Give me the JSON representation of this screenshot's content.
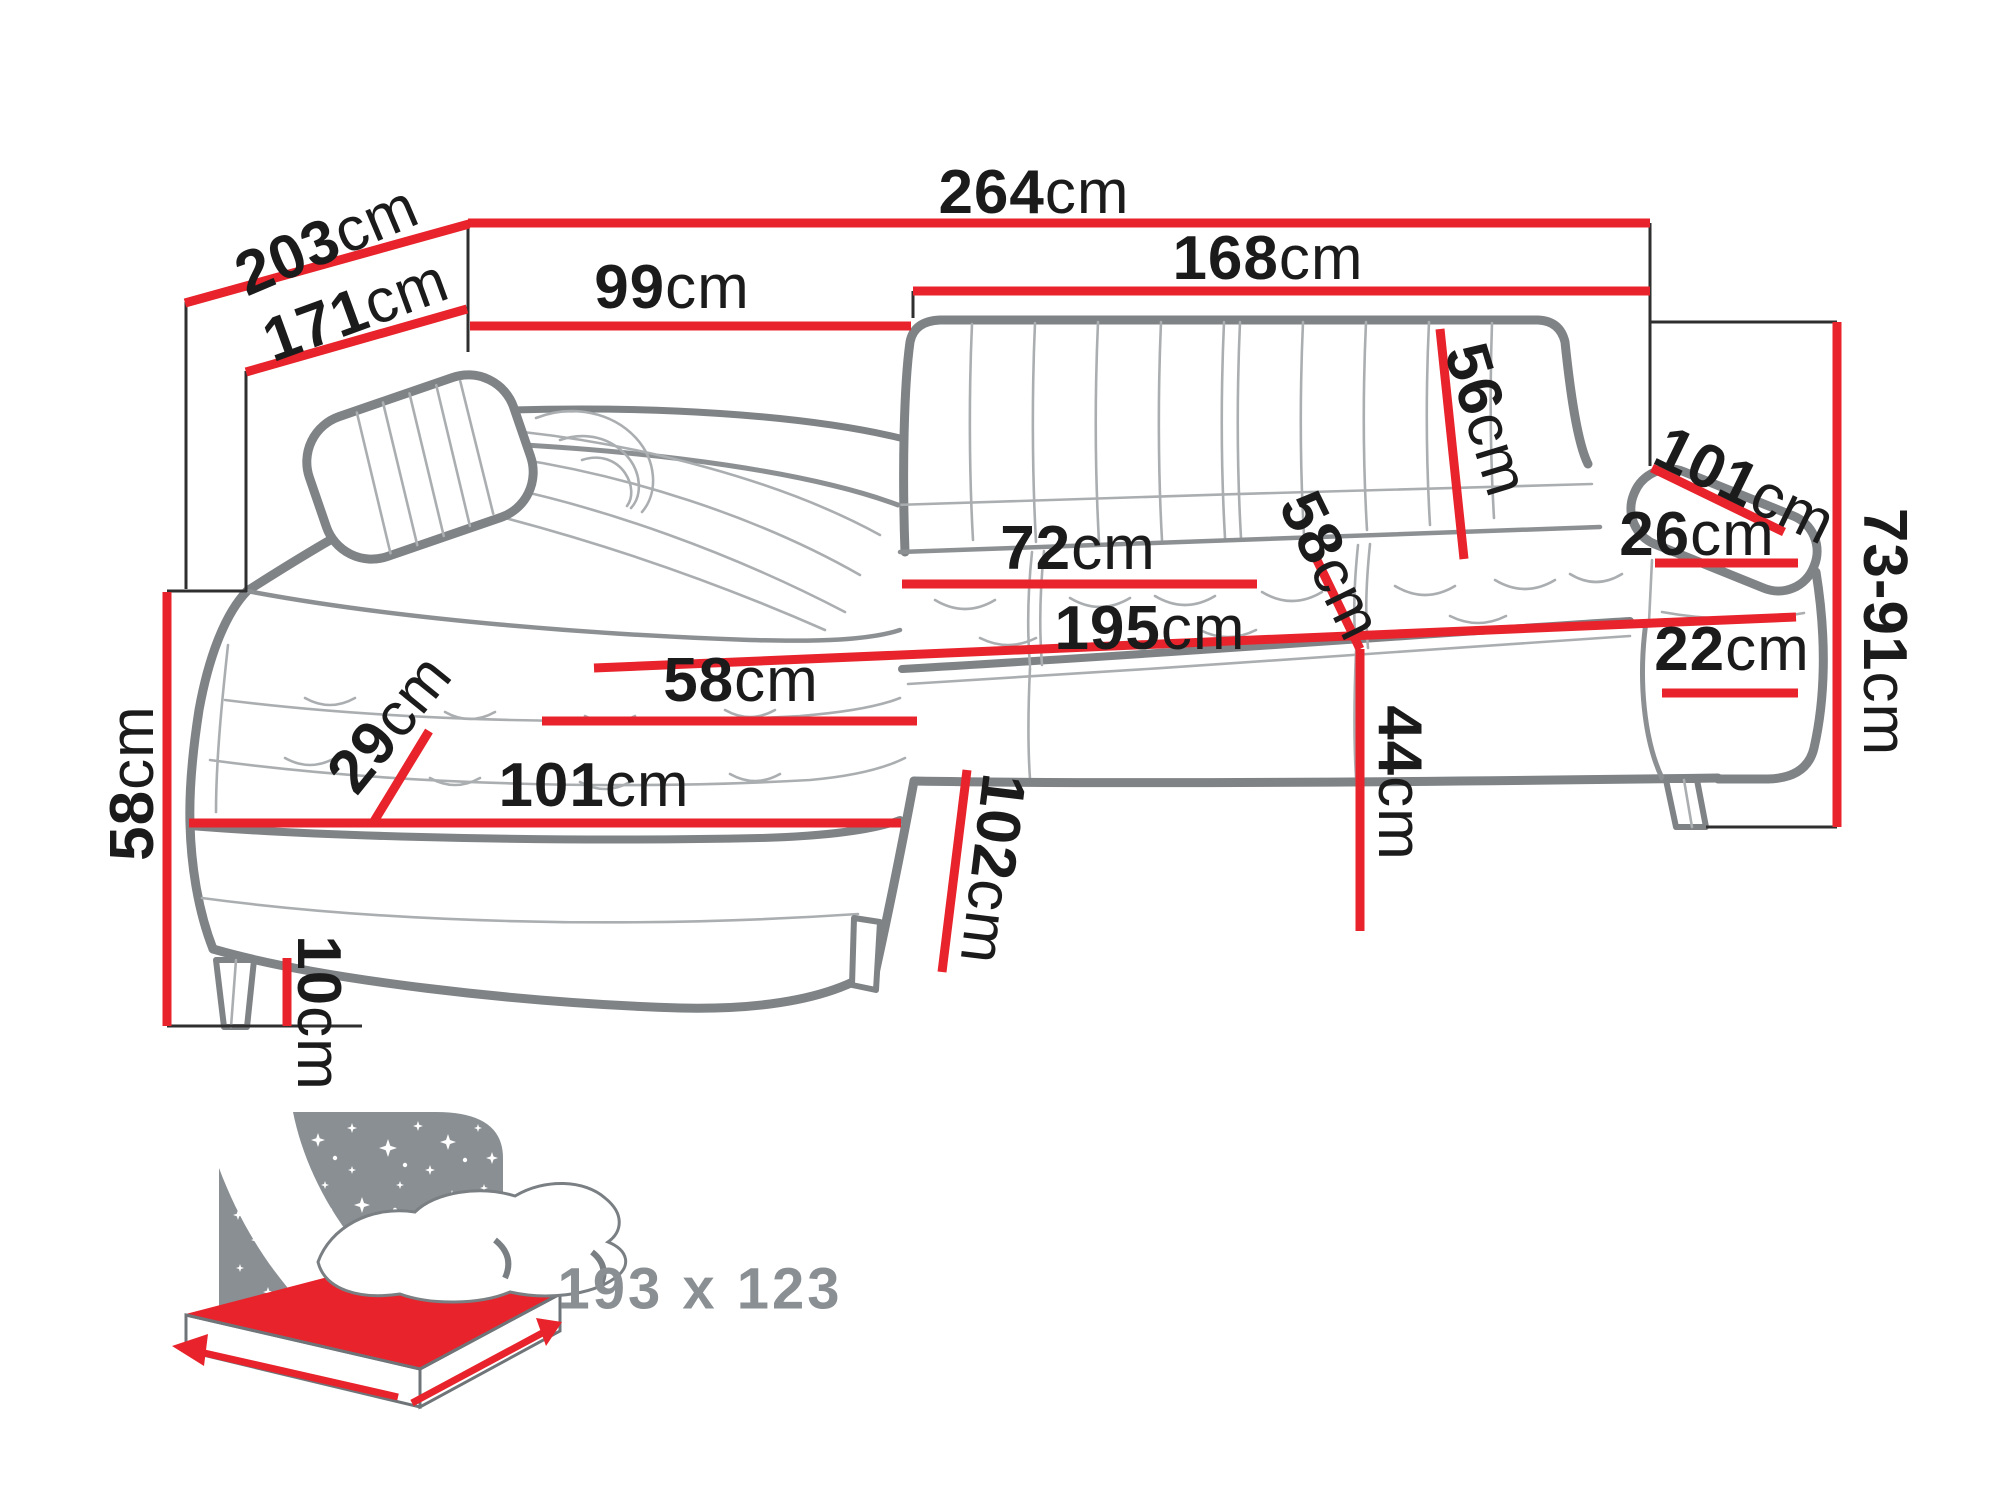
{
  "page": {
    "background": "#ffffff",
    "type": "furniture dimension diagram"
  },
  "product": {
    "kind": "corner sofa bed with chaise longue",
    "view": "perspective line drawing"
  },
  "dims": {
    "d264": {
      "value": "264",
      "unit": "cm"
    },
    "d203": {
      "value": "203",
      "unit": "cm"
    },
    "d171": {
      "value": "171",
      "unit": "cm"
    },
    "d99": {
      "value": "99",
      "unit": "cm"
    },
    "d168": {
      "value": "168",
      "unit": "cm"
    },
    "d56": {
      "value": "56",
      "unit": "cm"
    },
    "d101R": {
      "value": "101",
      "unit": "cm"
    },
    "d26": {
      "value": "26",
      "unit": "cm"
    },
    "d7391": {
      "value": "73-91",
      "unit": "cm"
    },
    "d22": {
      "value": "22",
      "unit": "cm"
    },
    "d72": {
      "value": "72",
      "unit": "cm"
    },
    "d195": {
      "value": "195",
      "unit": "cm"
    },
    "d58mid": {
      "value": "58",
      "unit": "cm"
    },
    "d44": {
      "value": "44",
      "unit": "cm"
    },
    "d58L": {
      "value": "58",
      "unit": "cm"
    },
    "d29": {
      "value": "29",
      "unit": "cm"
    },
    "d101L": {
      "value": "101",
      "unit": "cm"
    },
    "d58V": {
      "value": "58",
      "unit": "cm"
    },
    "d10": {
      "value": "10",
      "unit": "cm"
    },
    "d102": {
      "value": "102",
      "unit": "cm"
    }
  },
  "bed_icon": {
    "size_label": "193 x 123"
  },
  "colors": {
    "dimension_red": "#e8232b",
    "outline_gray": "#7f8386",
    "detail_gray": "#abaeb0",
    "label_black": "#1b1b1b",
    "icon_gray": "#8a8f93"
  }
}
